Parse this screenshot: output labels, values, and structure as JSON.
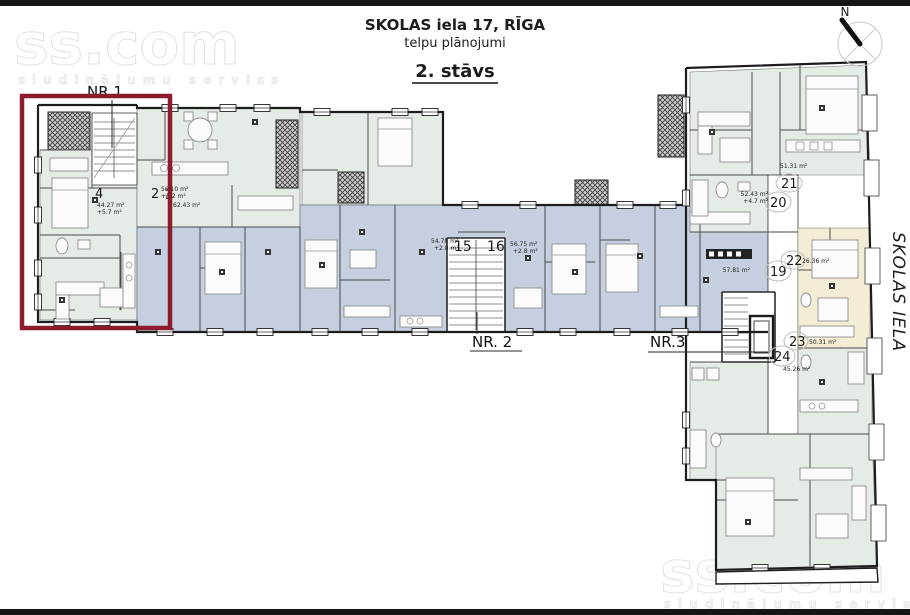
{
  "title": {
    "address": "SKOLAS iela 17, RĪGA",
    "subtitle": "telpu plānojumi",
    "floor": "2. stāvs"
  },
  "watermark": {
    "brand": "ss.com",
    "tagline": "sludinājumu serviss"
  },
  "compass": {
    "north": "N"
  },
  "street": {
    "name": "SKOLAS IELA"
  },
  "entrances": {
    "nr1": "NR 1",
    "nr2": "NR. 2",
    "nr3": "NR.3"
  },
  "apartments": {
    "a2": {
      "number": "2",
      "area": "56.10 m²",
      "extra": "+6.2 m²"
    },
    "a3": {
      "number": "3",
      "area": "62.43 m²",
      "extra": ""
    },
    "a4": {
      "number": "4",
      "area": "44.27 m²",
      "extra": "+5.7 m²"
    },
    "a15": {
      "number": "15",
      "area": "54.78 m²",
      "extra": "+2.8 m²"
    },
    "a16": {
      "number": "16",
      "area": "56.75 m²",
      "extra": "+2.8 m²"
    },
    "a19": {
      "number": "19",
      "area": "57.81 m²",
      "extra": ""
    },
    "a20": {
      "number": "20",
      "area": "52.43 m²",
      "extra": "+4.7 m²"
    },
    "a21": {
      "number": "21",
      "area": "51.31 m²",
      "extra": ""
    },
    "a22": {
      "number": "22",
      "area": "26.36 m²",
      "extra": ""
    },
    "a23": {
      "number": "23",
      "area": "50.31 m²",
      "extra": ""
    },
    "a24": {
      "number": "24",
      "area": "45.26 m²",
      "extra": ""
    }
  },
  "colors": {
    "highlight_red": "#8d1b2c",
    "room_blue": "#c5cfdf",
    "room_green": "#e5ebe5",
    "room_beige": "#f4edd6",
    "wall": "#1d1d1d"
  }
}
